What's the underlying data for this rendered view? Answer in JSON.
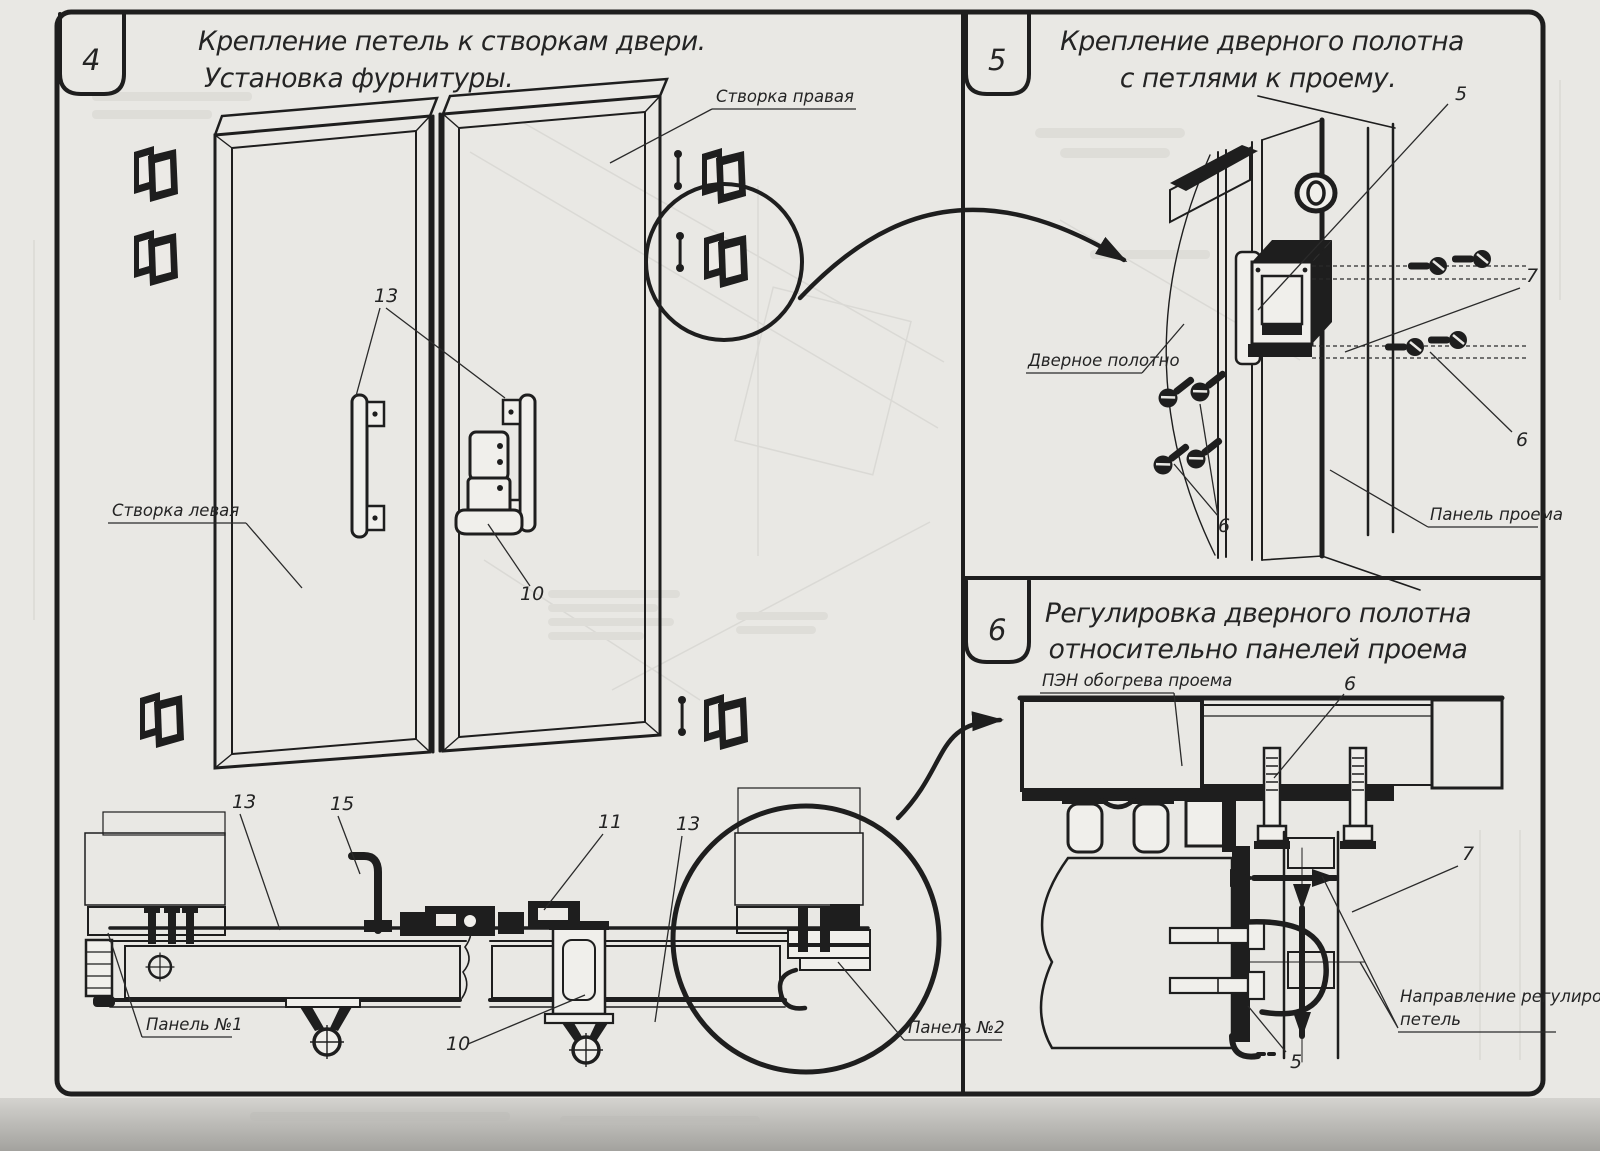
{
  "drawing": {
    "panels": [
      {
        "number": "4",
        "title": [
          "Крепление петель к створкам двери.",
          "Установка фурнитуры."
        ]
      },
      {
        "number": "5",
        "title": [
          "Крепление дверного полотна",
          "с петлями к проему."
        ]
      },
      {
        "number": "6",
        "title": [
          "Регулировка дверного полотна",
          "относительно панелей проема"
        ]
      }
    ],
    "panel4": {
      "label_leaf_right": "Створка правая",
      "label_leaf_left": "Створка левая",
      "callout_13_handles": "13",
      "callout_10_lock": "10",
      "callout_13_section_left": "13",
      "callout_15_section": "15",
      "callout_11_section": "11",
      "callout_13_section_right": "13",
      "callout_10_section": "10",
      "label_panel_no1": "Панель №1",
      "label_panel_no2": "Панель №2"
    },
    "panel5": {
      "callout_5_hinge": "5",
      "callout_7_screws": "7",
      "callout_6_screws_right": "6",
      "callout_6_screws_left": "6",
      "label_door_leaf": "Дверное полотно",
      "label_opening_panel": "Панель проема"
    },
    "panel6": {
      "label_pen_heater": "ПЭН обогрева проема",
      "callout_6_bolts": "6",
      "callout_7_hinge": "7",
      "callout_5_hinge": "5",
      "label_adjust_direction": [
        "Направление регулировки",
        "петель"
      ]
    }
  }
}
